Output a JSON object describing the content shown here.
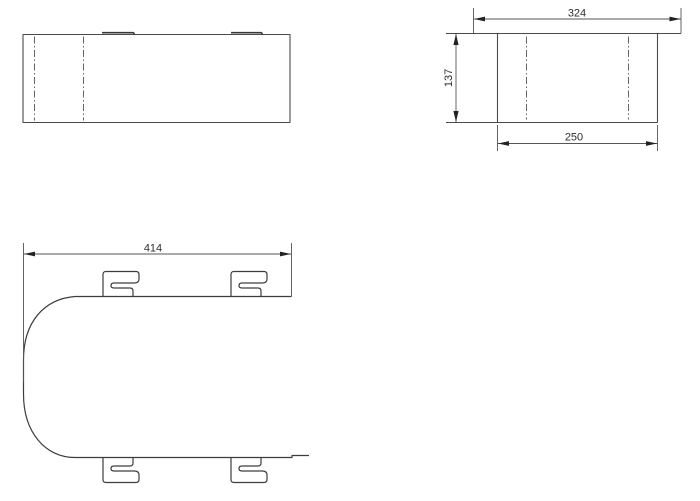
{
  "document": {
    "background": "#ffffff",
    "object_line_color": "#4a4a4a",
    "centerline_color": "#666666",
    "dimension_line_color": "#545454",
    "arrow_color": "#222222",
    "text_color": "#2d2d2d"
  },
  "dimensions": {
    "flange_width": "324",
    "height": "137",
    "body_width": "250",
    "length": "414"
  }
}
